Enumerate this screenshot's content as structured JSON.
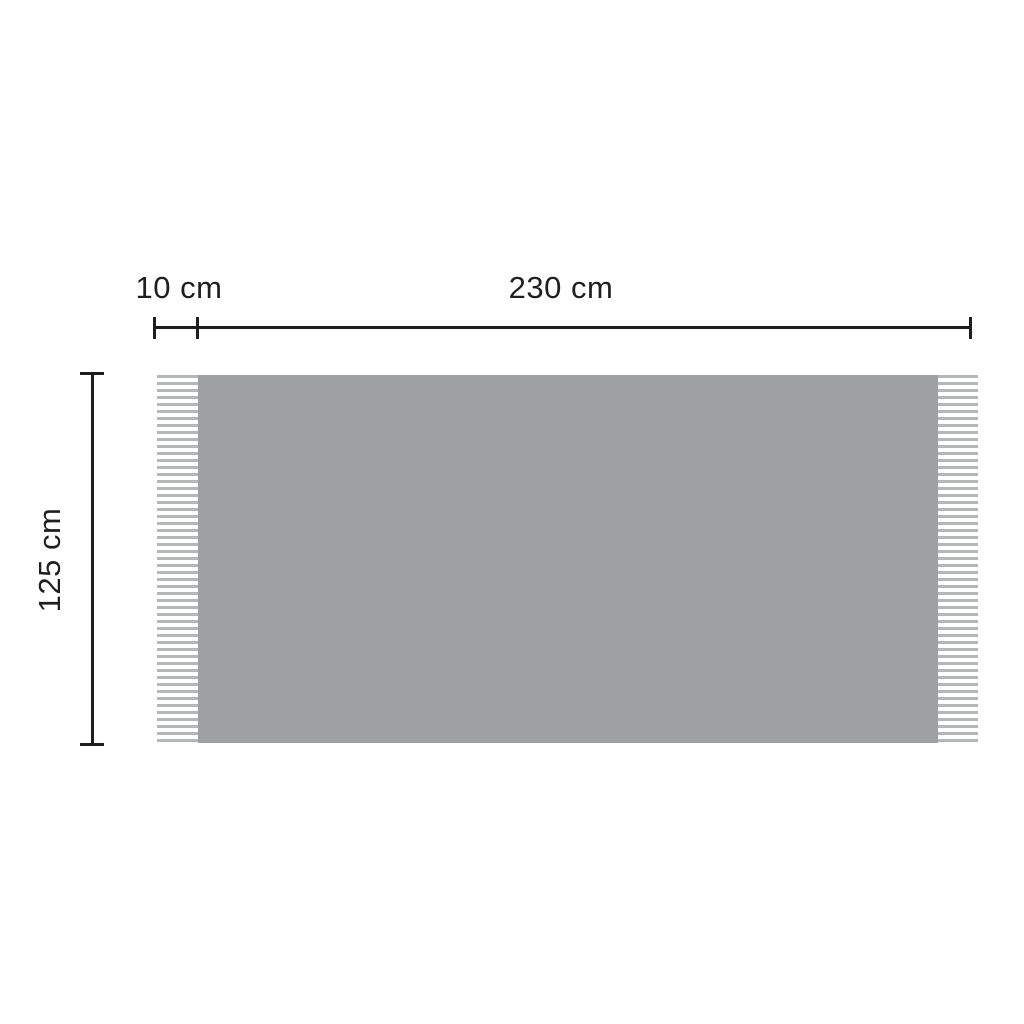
{
  "diagram": {
    "labels": {
      "fringe_width": "10 cm",
      "body_width": "230 cm",
      "height": "125 cm"
    },
    "colors": {
      "background": "#ffffff",
      "line": "#1d1d1d",
      "text": "#1f1f1f",
      "blanket_body": "#9da1a4",
      "fringe": "#b4b6b7"
    }
  }
}
